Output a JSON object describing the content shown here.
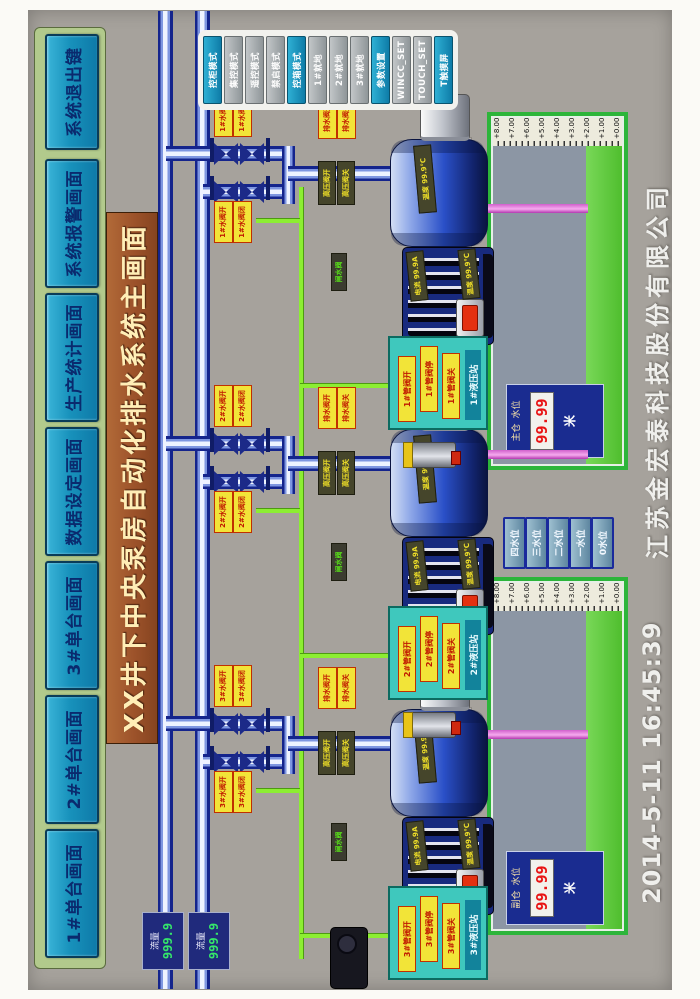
{
  "menu": {
    "items": [
      "1#单台画面",
      "2#单台画面",
      "3#单台画面",
      "数据设定画面",
      "生产统计画面",
      "系统报警画面",
      "系统退出键"
    ]
  },
  "title": "XX井下中央泵房自动化排水系统主画面",
  "control_panel": {
    "buttons": [
      {
        "label": "控柜模式",
        "style": "teal"
      },
      {
        "label": "集控模式",
        "style": "gray"
      },
      {
        "label": "遥控模式",
        "style": "gray"
      },
      {
        "label": "禁启模式",
        "style": "gray"
      },
      {
        "label": "控箱模式",
        "style": "teal"
      },
      {
        "label": "1#就地",
        "style": "gray"
      },
      {
        "label": "2#就地",
        "style": "gray"
      },
      {
        "label": "3#就地",
        "style": "gray"
      },
      {
        "label": "参数设置",
        "style": "teal"
      },
      {
        "label": "WINCC_SET",
        "style": "gray"
      },
      {
        "label": "TOUCH_SET",
        "style": "gray"
      },
      {
        "label": "T触摸屏",
        "style": "teal"
      }
    ]
  },
  "flow_meters": [
    {
      "label": "流量",
      "value": "999.9"
    },
    {
      "label": "流量",
      "value": "999.9"
    }
  ],
  "pumps": [
    {
      "valve_pair_a": [
        "1#水阀开",
        "1#水阀闭"
      ],
      "valve_pair_b": [
        "1#水阀开",
        "1#水阀闭"
      ],
      "valve_pair_c": [
        "排水阀开",
        "排水阀关"
      ],
      "hp_pair": [
        "高压阀开",
        "高压阀关"
      ],
      "gate_label": "闸水阀",
      "pump_temp": "温度 99.9℃",
      "motor_current": "电流 99.9A",
      "motor_temp": "温度 99.9℃",
      "panel": {
        "buttons": [
          "1#管阀开",
          "1#管阀停",
          "1#管阀关"
        ],
        "title": "1#液压站"
      }
    },
    {
      "valve_pair_a": [
        "2#水阀开",
        "2#水阀闭"
      ],
      "valve_pair_b": [
        "2#水阀开",
        "2#水阀闭"
      ],
      "valve_pair_c": [
        "排水阀开",
        "排水阀关"
      ],
      "hp_pair": [
        "高压阀开",
        "高压阀关"
      ],
      "gate_label": "闸水阀",
      "pump_temp": "温度 99.9℃",
      "motor_current": "电流 99.9A",
      "motor_temp": "温度 99.9℃",
      "panel": {
        "buttons": [
          "2#管阀开",
          "2#管阀停",
          "2#管阀关"
        ],
        "title": "2#液压站"
      }
    },
    {
      "valve_pair_a": [
        "3#水阀开",
        "3#水阀闭"
      ],
      "valve_pair_b": [
        "3#水阀开",
        "3#水阀闭"
      ],
      "valve_pair_c": [
        "排水阀开",
        "排水阀关"
      ],
      "hp_pair": [
        "高压阀开",
        "高压阀关"
      ],
      "gate_label": "闸水阀",
      "pump_temp": "温度 99.9℃",
      "motor_current": "电流 99.9A",
      "motor_temp": "温度 99.9℃",
      "panel": {
        "buttons": [
          "3#管阀开",
          "3#管阀停",
          "3#管阀关"
        ],
        "title": "3#液压站"
      }
    }
  ],
  "tanks": [
    {
      "label_1": "主仓",
      "label_2": "水位",
      "value": "99.99",
      "unit": "米"
    },
    {
      "label_1": "副仓",
      "label_2": "水位",
      "value": "99.99",
      "unit": "米"
    }
  ],
  "tank_scale": [
    "+8.00",
    "+7.00",
    "+6.00",
    "+5.00",
    "+4.00",
    "+3.00",
    "+2.00",
    "+1.00",
    "+0.00"
  ],
  "level_buttons": [
    "四水位",
    "三水位",
    "二水位",
    "一水位",
    "0水位"
  ],
  "status": {
    "datetime": "2014-5-11  16:45:39",
    "company": "江苏金宏泰科技股份有限公司"
  },
  "colors": {
    "accent_teal": "#1b9ec2",
    "menu_green": "#b2ca8c",
    "title_brown": "#9c522a",
    "pipe_blue": "#2038a8",
    "lime": "#8cee32",
    "pink_pipe": "#e87fd8",
    "water_green": "#55c437",
    "led_red": "#e81414",
    "flow_green": "#35e86a"
  }
}
